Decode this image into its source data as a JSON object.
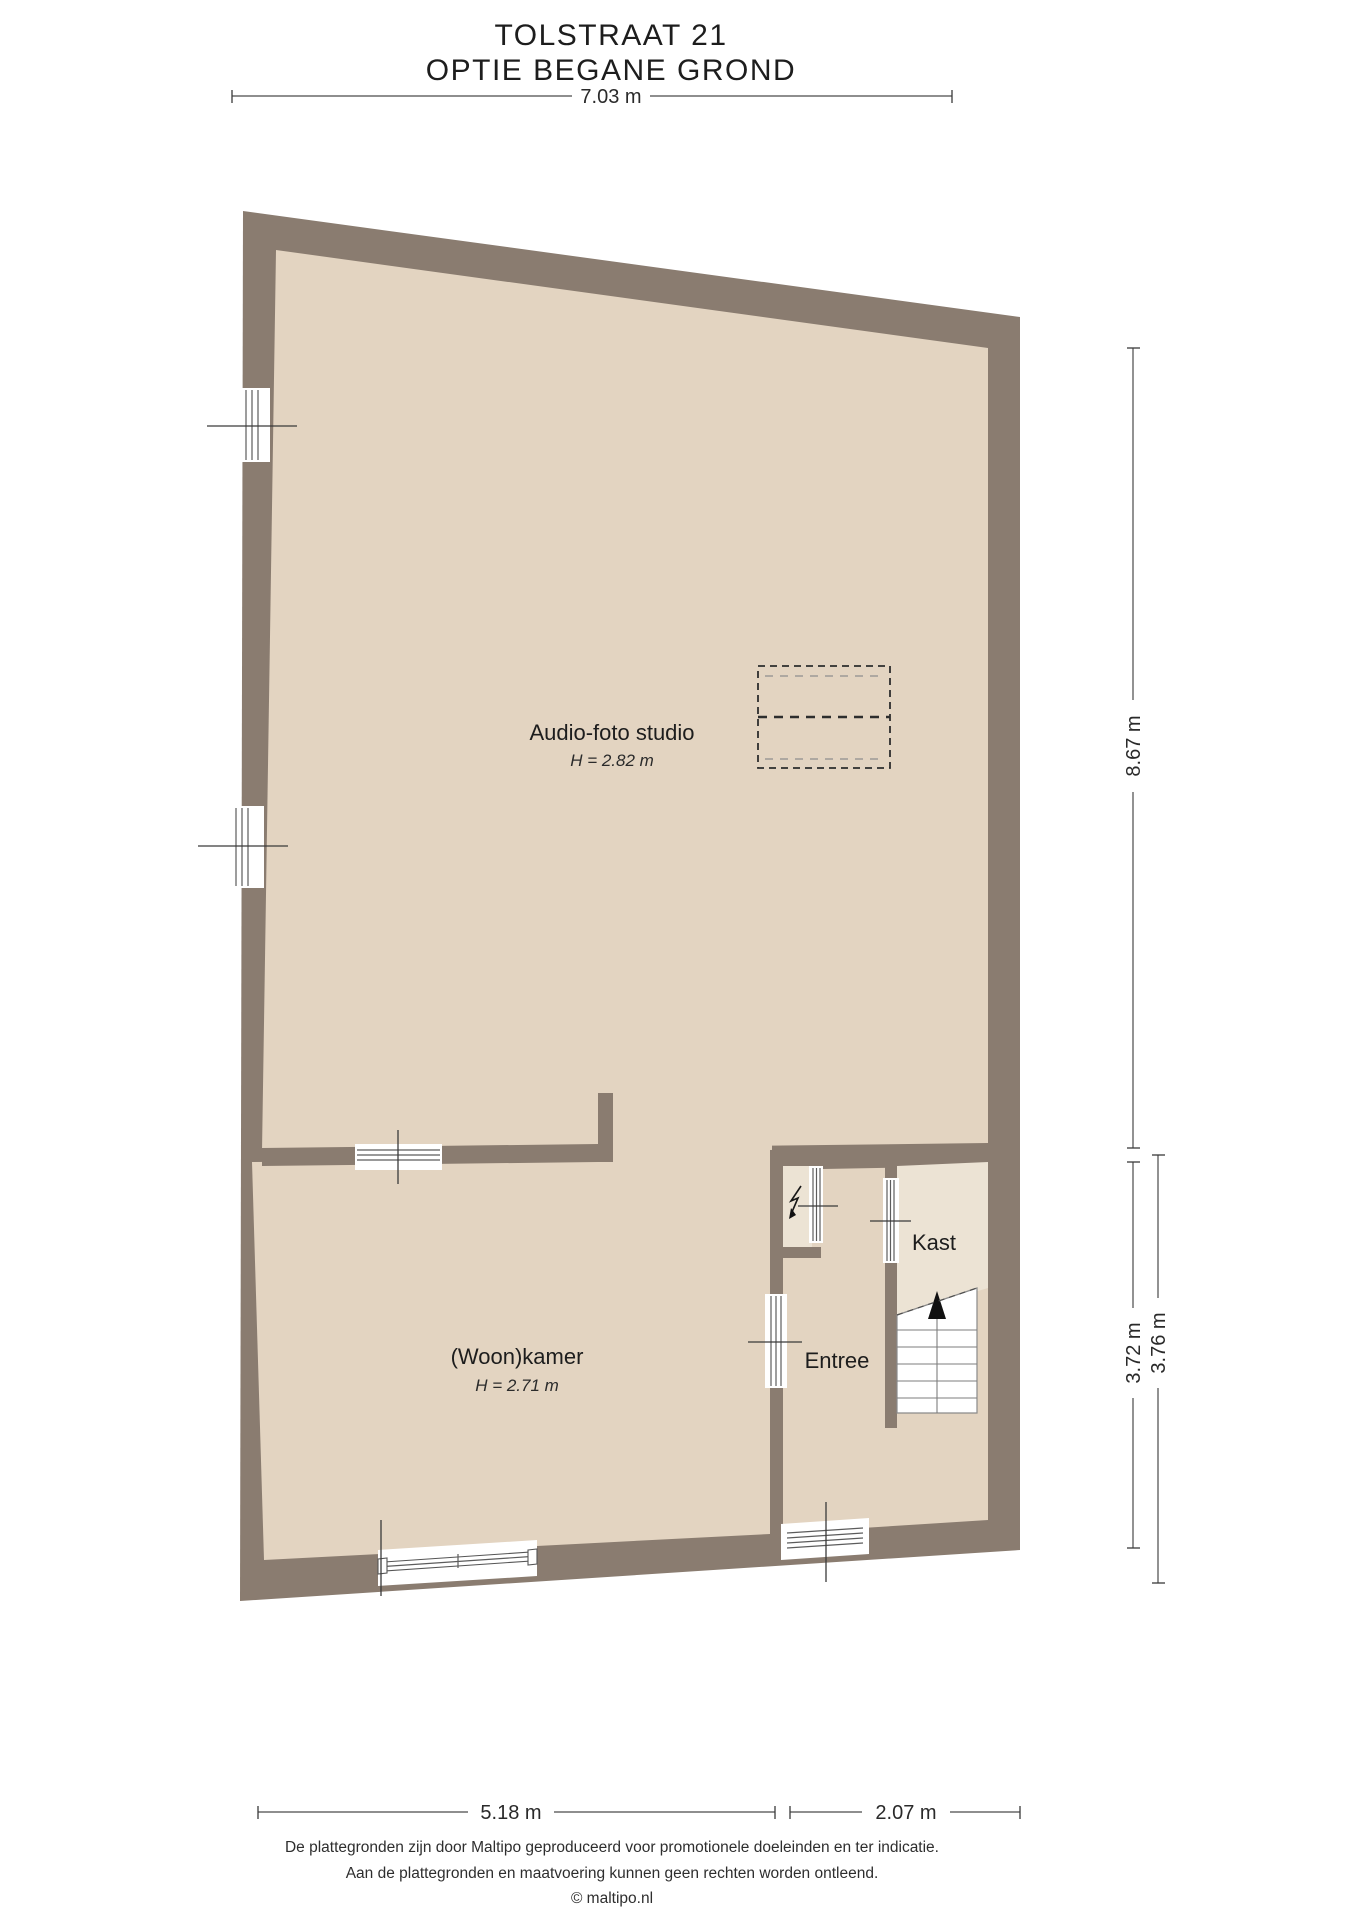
{
  "title": {
    "line1": "TOLSTRAAT 21",
    "line2": "OPTIE BEGANE GROND"
  },
  "rooms": {
    "studio": {
      "name": "Audio-foto studio",
      "height": "H = 2.82 m"
    },
    "living": {
      "name": "(Woon)kamer",
      "height": "H = 2.71 m"
    },
    "entry": {
      "name": "Entree"
    },
    "closet": {
      "name": "Kast"
    }
  },
  "dimensions": {
    "top": "7.03 m",
    "right_upper": "8.67 m",
    "right_lower_inner": "3.72 m",
    "right_lower_outer": "3.76 m",
    "bottom_left": "5.18 m",
    "bottom_right": "2.07 m"
  },
  "footer": {
    "line1": "De plattegronden zijn door Maltipo geproduceerd voor promotionele doeleinden en ter indicatie.",
    "line2": "Aan de plattegronden en maatvoering kunnen geen rechten worden ontleend.",
    "line3": "© maltipo.nl"
  },
  "colors": {
    "wall": "#8a7c70",
    "floor": "#e3d4c1",
    "closet_floor": "#ece3d4",
    "stairs": "#ffffff",
    "arrow": "#111111"
  }
}
